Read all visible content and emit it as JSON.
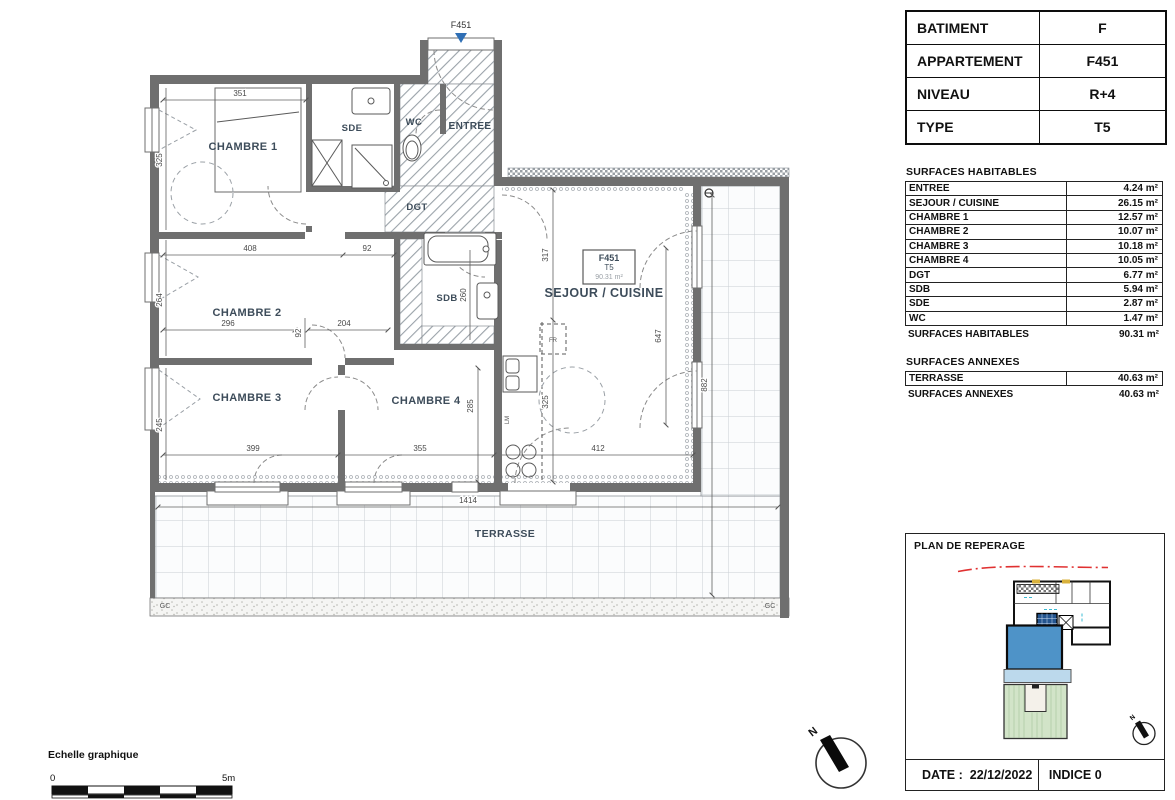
{
  "info_table": {
    "rows": [
      {
        "label": "BATIMENT",
        "value": "F"
      },
      {
        "label": "APPARTEMENT",
        "value": "F451"
      },
      {
        "label": "NIVEAU",
        "value": "R+4"
      },
      {
        "label": "TYPE",
        "value": "T5"
      }
    ]
  },
  "surfaces": {
    "title": "SURFACES HABITABLES",
    "rows": [
      {
        "label": "ENTREE",
        "value": "4.24 m²"
      },
      {
        "label": "SEJOUR / CUISINE",
        "value": "26.15 m²"
      },
      {
        "label": "CHAMBRE 1",
        "value": "12.57 m²"
      },
      {
        "label": "CHAMBRE 2",
        "value": "10.07 m²"
      },
      {
        "label": "CHAMBRE 3",
        "value": "10.18 m²"
      },
      {
        "label": "CHAMBRE 4",
        "value": "10.05 m²"
      },
      {
        "label": "DGT",
        "value": "6.77 m²"
      },
      {
        "label": "SDB",
        "value": "5.94 m²"
      },
      {
        "label": "SDE",
        "value": "2.87 m²"
      },
      {
        "label": "WC",
        "value": "1.47 m²"
      }
    ],
    "total": {
      "label": "SURFACES HABITABLES",
      "value": "90.31 m²"
    },
    "annexes_title": "SURFACES ANNEXES",
    "annexes_rows": [
      {
        "label": "TERRASSE",
        "value": "40.63 m²"
      }
    ],
    "annexes_total": {
      "label": "SURFACES ANNEXES",
      "value": "40.63 m²"
    }
  },
  "reperage": {
    "title": "PLAN DE REPERAGE",
    "date_label": "DATE :",
    "date_value": "22/12/2022",
    "indice": "INDICE 0",
    "north": "N"
  },
  "plan": {
    "marker": "F451",
    "unit_tag": {
      "code": "F451",
      "type": "T5",
      "area": "90.31 m²"
    },
    "rooms": [
      "CHAMBRE 1",
      "SDE",
      "WC",
      "ENTREE",
      "DGT",
      "CHAMBRE 2",
      "SDB",
      "CHAMBRE 3",
      "CHAMBRE 4",
      "SEJOUR / CUISINE",
      "TERRASSE"
    ],
    "dims": [
      "351",
      "408",
      "92",
      "296",
      "92",
      "204",
      "260",
      "317",
      "647",
      "325",
      "285",
      "882",
      "399",
      "355",
      "412",
      "1414",
      "325",
      "264",
      "245"
    ],
    "labels": {
      "gc": "GC",
      "fr": "FR",
      "lm": "LM",
      "north": "N"
    }
  },
  "scalebar": {
    "title": "Echelle graphique",
    "start": "0",
    "end": "5m"
  },
  "colors": {
    "wall": "#6f6f6f",
    "room_text": "#3d4c5a",
    "unit_blue": "#4e93c8",
    "unit_blue_light": "#bcd9ec",
    "garden_green": "#d2e4c8",
    "marker_blue": "#2f6fb5",
    "red_line": "#e03131"
  }
}
